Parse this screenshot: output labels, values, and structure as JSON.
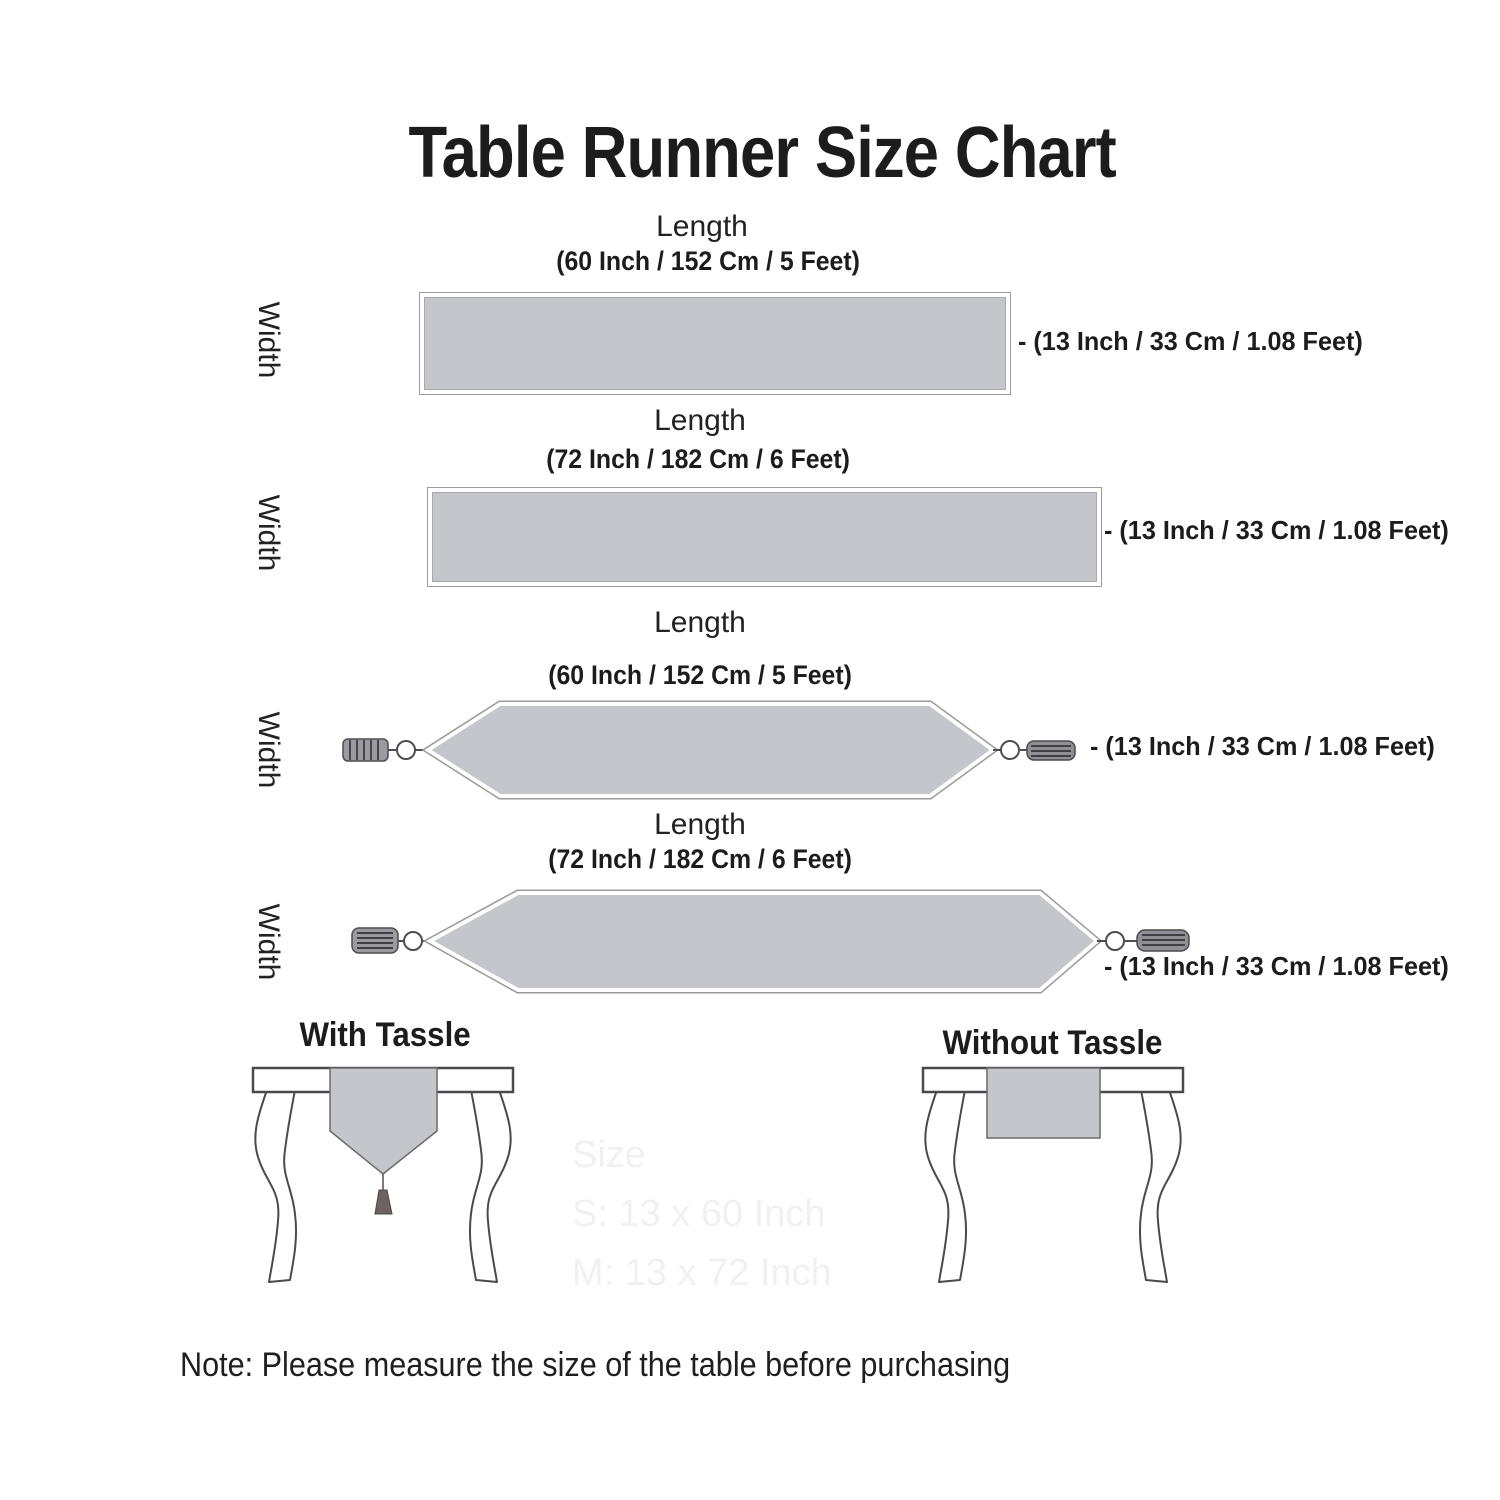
{
  "title": "Table Runner Size Chart",
  "runners": [
    {
      "shape": "rectangle",
      "length_label": "Length",
      "length_value": "(60 Inch / 152 Cm / 5 Feet)",
      "width_label": "Width",
      "width_value": "- (13 Inch / 33 Cm / 1.08 Feet)"
    },
    {
      "shape": "rectangle",
      "length_label": "Length",
      "length_value": "(72 Inch / 182 Cm / 6 Feet)",
      "width_label": "Width",
      "width_value": "- (13 Inch / 33 Cm / 1.08 Feet)"
    },
    {
      "shape": "pointed-with-tassels",
      "length_label": "Length",
      "length_value": "(60 Inch / 152 Cm / 5 Feet)",
      "width_label": "Width",
      "width_value": "- (13 Inch / 33 Cm / 1.08 Feet)"
    },
    {
      "shape": "pointed-with-tassels",
      "length_label": "Length",
      "length_value": "(72 Inch / 182 Cm / 6 Feet)",
      "width_label": "Width",
      "width_value": "- (13 Inch / 33 Cm / 1.08 Feet)"
    }
  ],
  "style_examples": [
    {
      "caption": "With Tassle"
    },
    {
      "caption": "Without Tassle"
    }
  ],
  "watermark": {
    "line1": "Size",
    "line2": "S: 13 x 60 Inch",
    "line3": "M: 13 x 72 Inch"
  },
  "note": "Note: Please measure the size of the table before purchasing",
  "colors": {
    "runner_fill": "#c5c6cc",
    "runner_border": "#9b9b9b",
    "text": "#1f1f1f",
    "table_outline": "#4a4a4a",
    "tassel": "#9a9aa0"
  }
}
